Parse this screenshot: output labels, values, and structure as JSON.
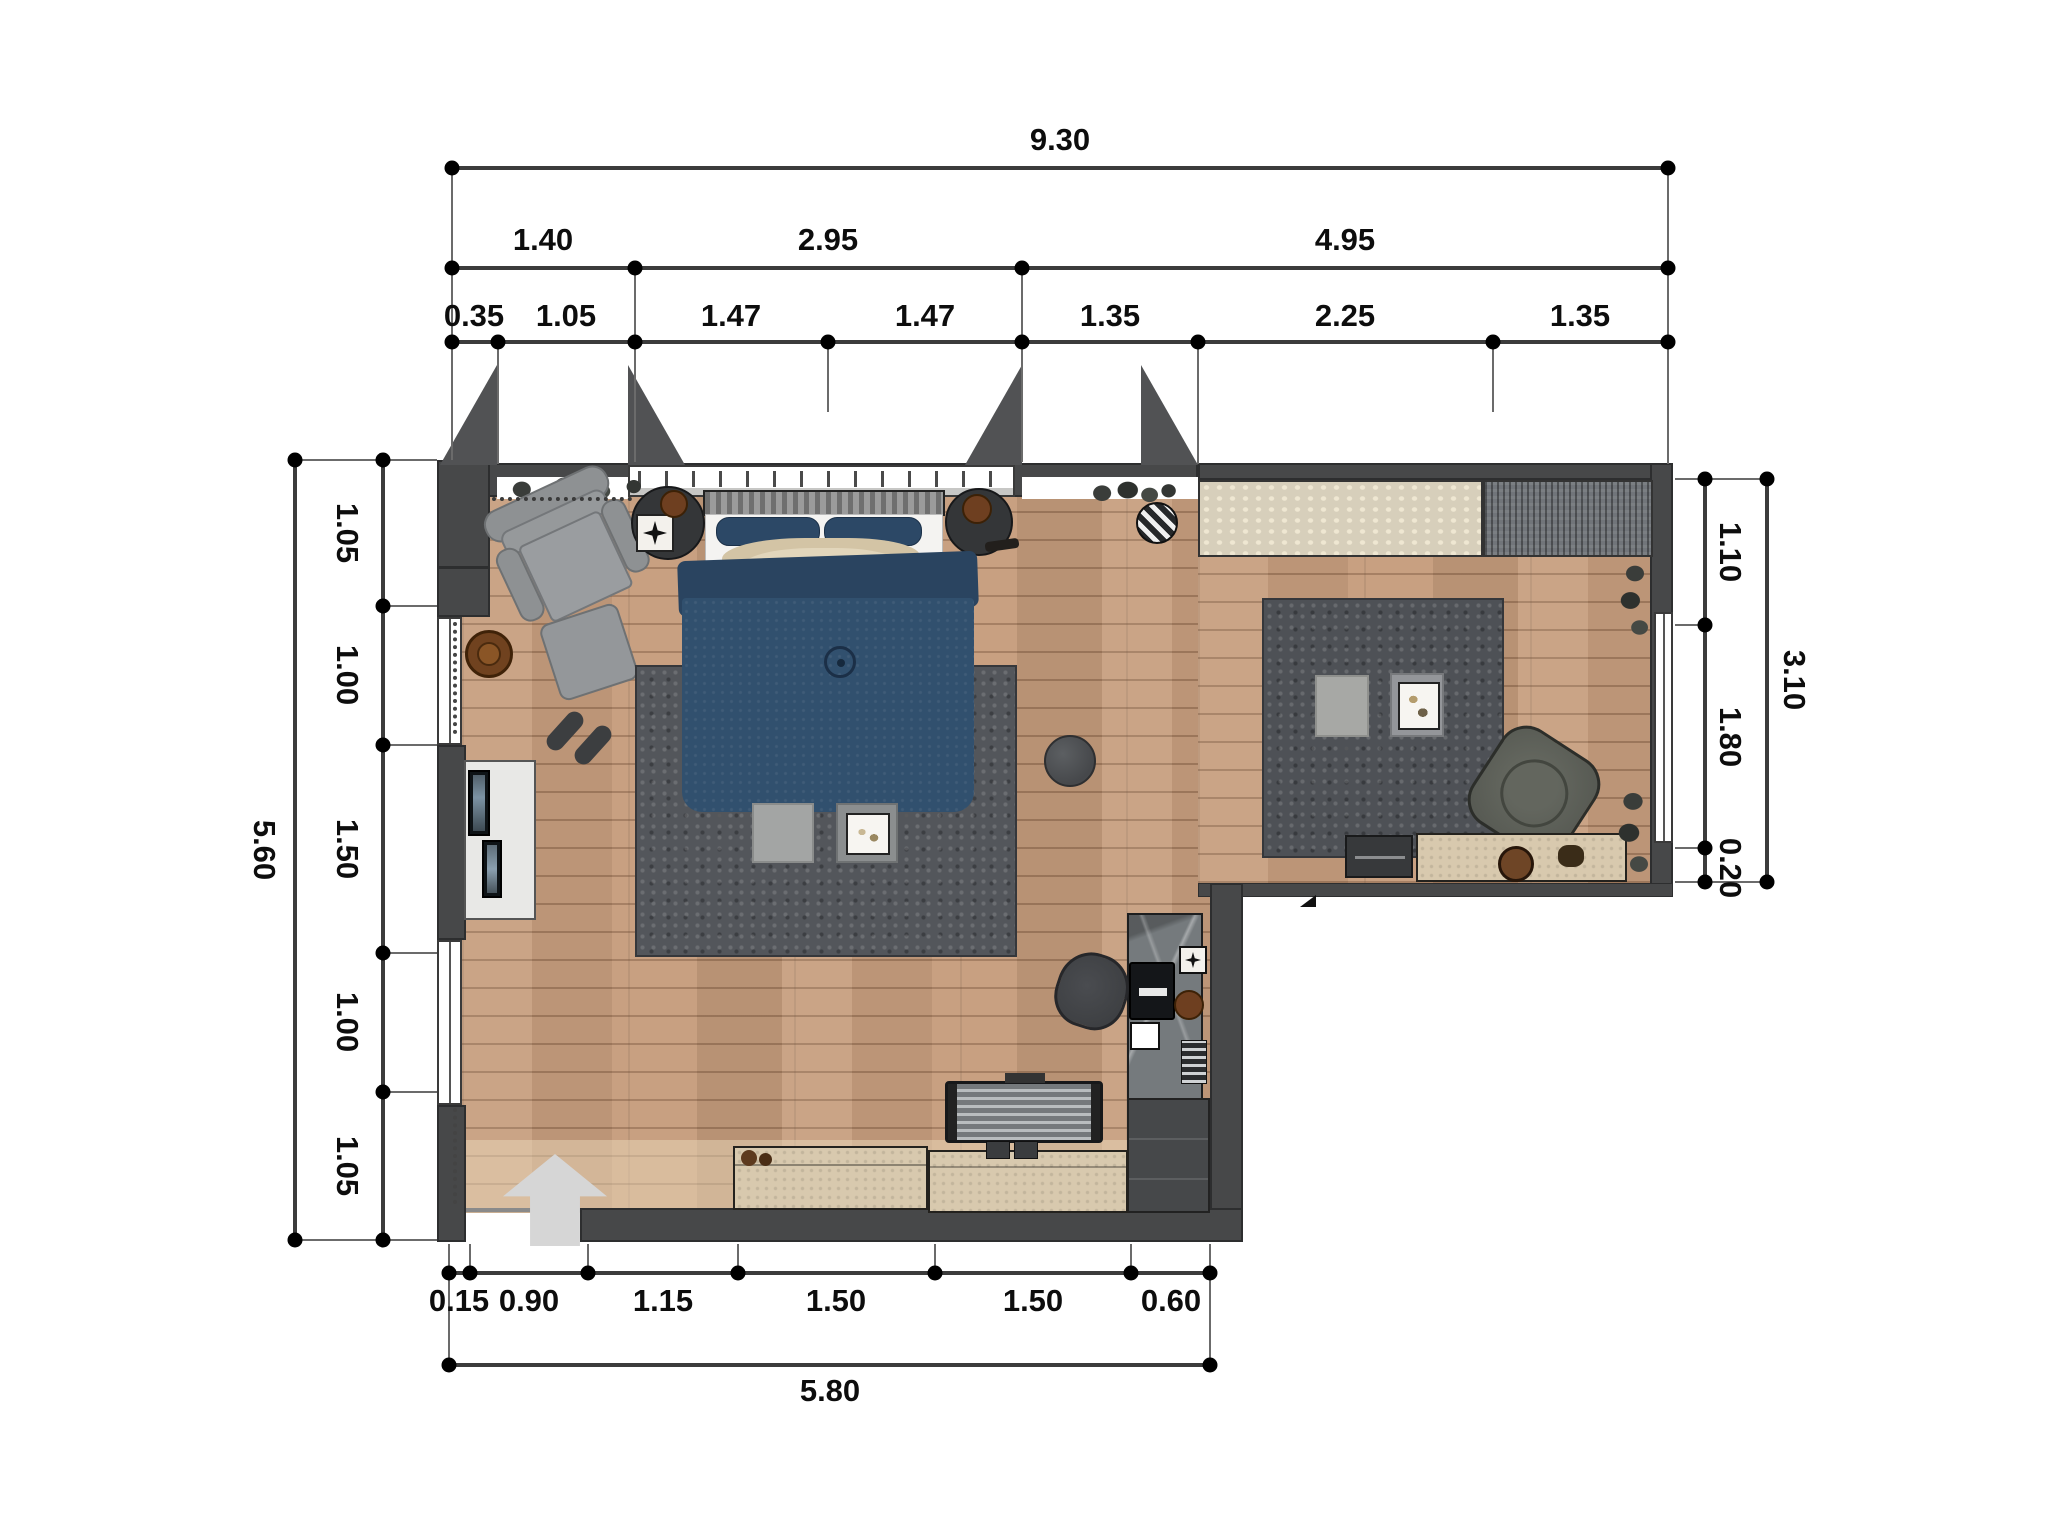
{
  "dimensions": {
    "top": {
      "total": "9.30",
      "groups": [
        "1.40",
        "2.95",
        "4.95"
      ],
      "segments": [
        "0.35",
        "1.05",
        "1.47",
        "1.47",
        "1.35",
        "2.25",
        "1.35"
      ]
    },
    "bottom": {
      "total": "5.80",
      "segments": [
        "0.15",
        "0.90",
        "1.15",
        "1.50",
        "1.50",
        "0.60"
      ]
    },
    "left": {
      "total": "5.60",
      "segments": [
        "1.05",
        "1.00",
        "1.50",
        "1.00",
        "1.05"
      ]
    },
    "right": {
      "total": "3.10",
      "segments": [
        "1.10",
        "1.80",
        "0.20"
      ]
    }
  },
  "palette": {
    "wall": "#474849",
    "floor_wood": "#c69d7d",
    "bed_navy": "#31506e",
    "rug_dark": "#53565b",
    "sideboard_beige": "#d8c9ae",
    "dimension_text": "#0d0d0d"
  },
  "furniture": [
    "armchair",
    "ottoman",
    "side-table",
    "nightstand-left",
    "nightstand-right",
    "double-bed",
    "bed-rug",
    "floor-cushions",
    "pouf",
    "dresser",
    "desk",
    "desk-chair",
    "corner-cabinet",
    "tv",
    "sideboards",
    "entrance-arrow",
    "bench-rug",
    "runner-rug",
    "living-rug",
    "tray-table",
    "lounge-chair",
    "tv-unit",
    "stool",
    "radiator",
    "plants",
    "double-doors",
    "windows"
  ]
}
